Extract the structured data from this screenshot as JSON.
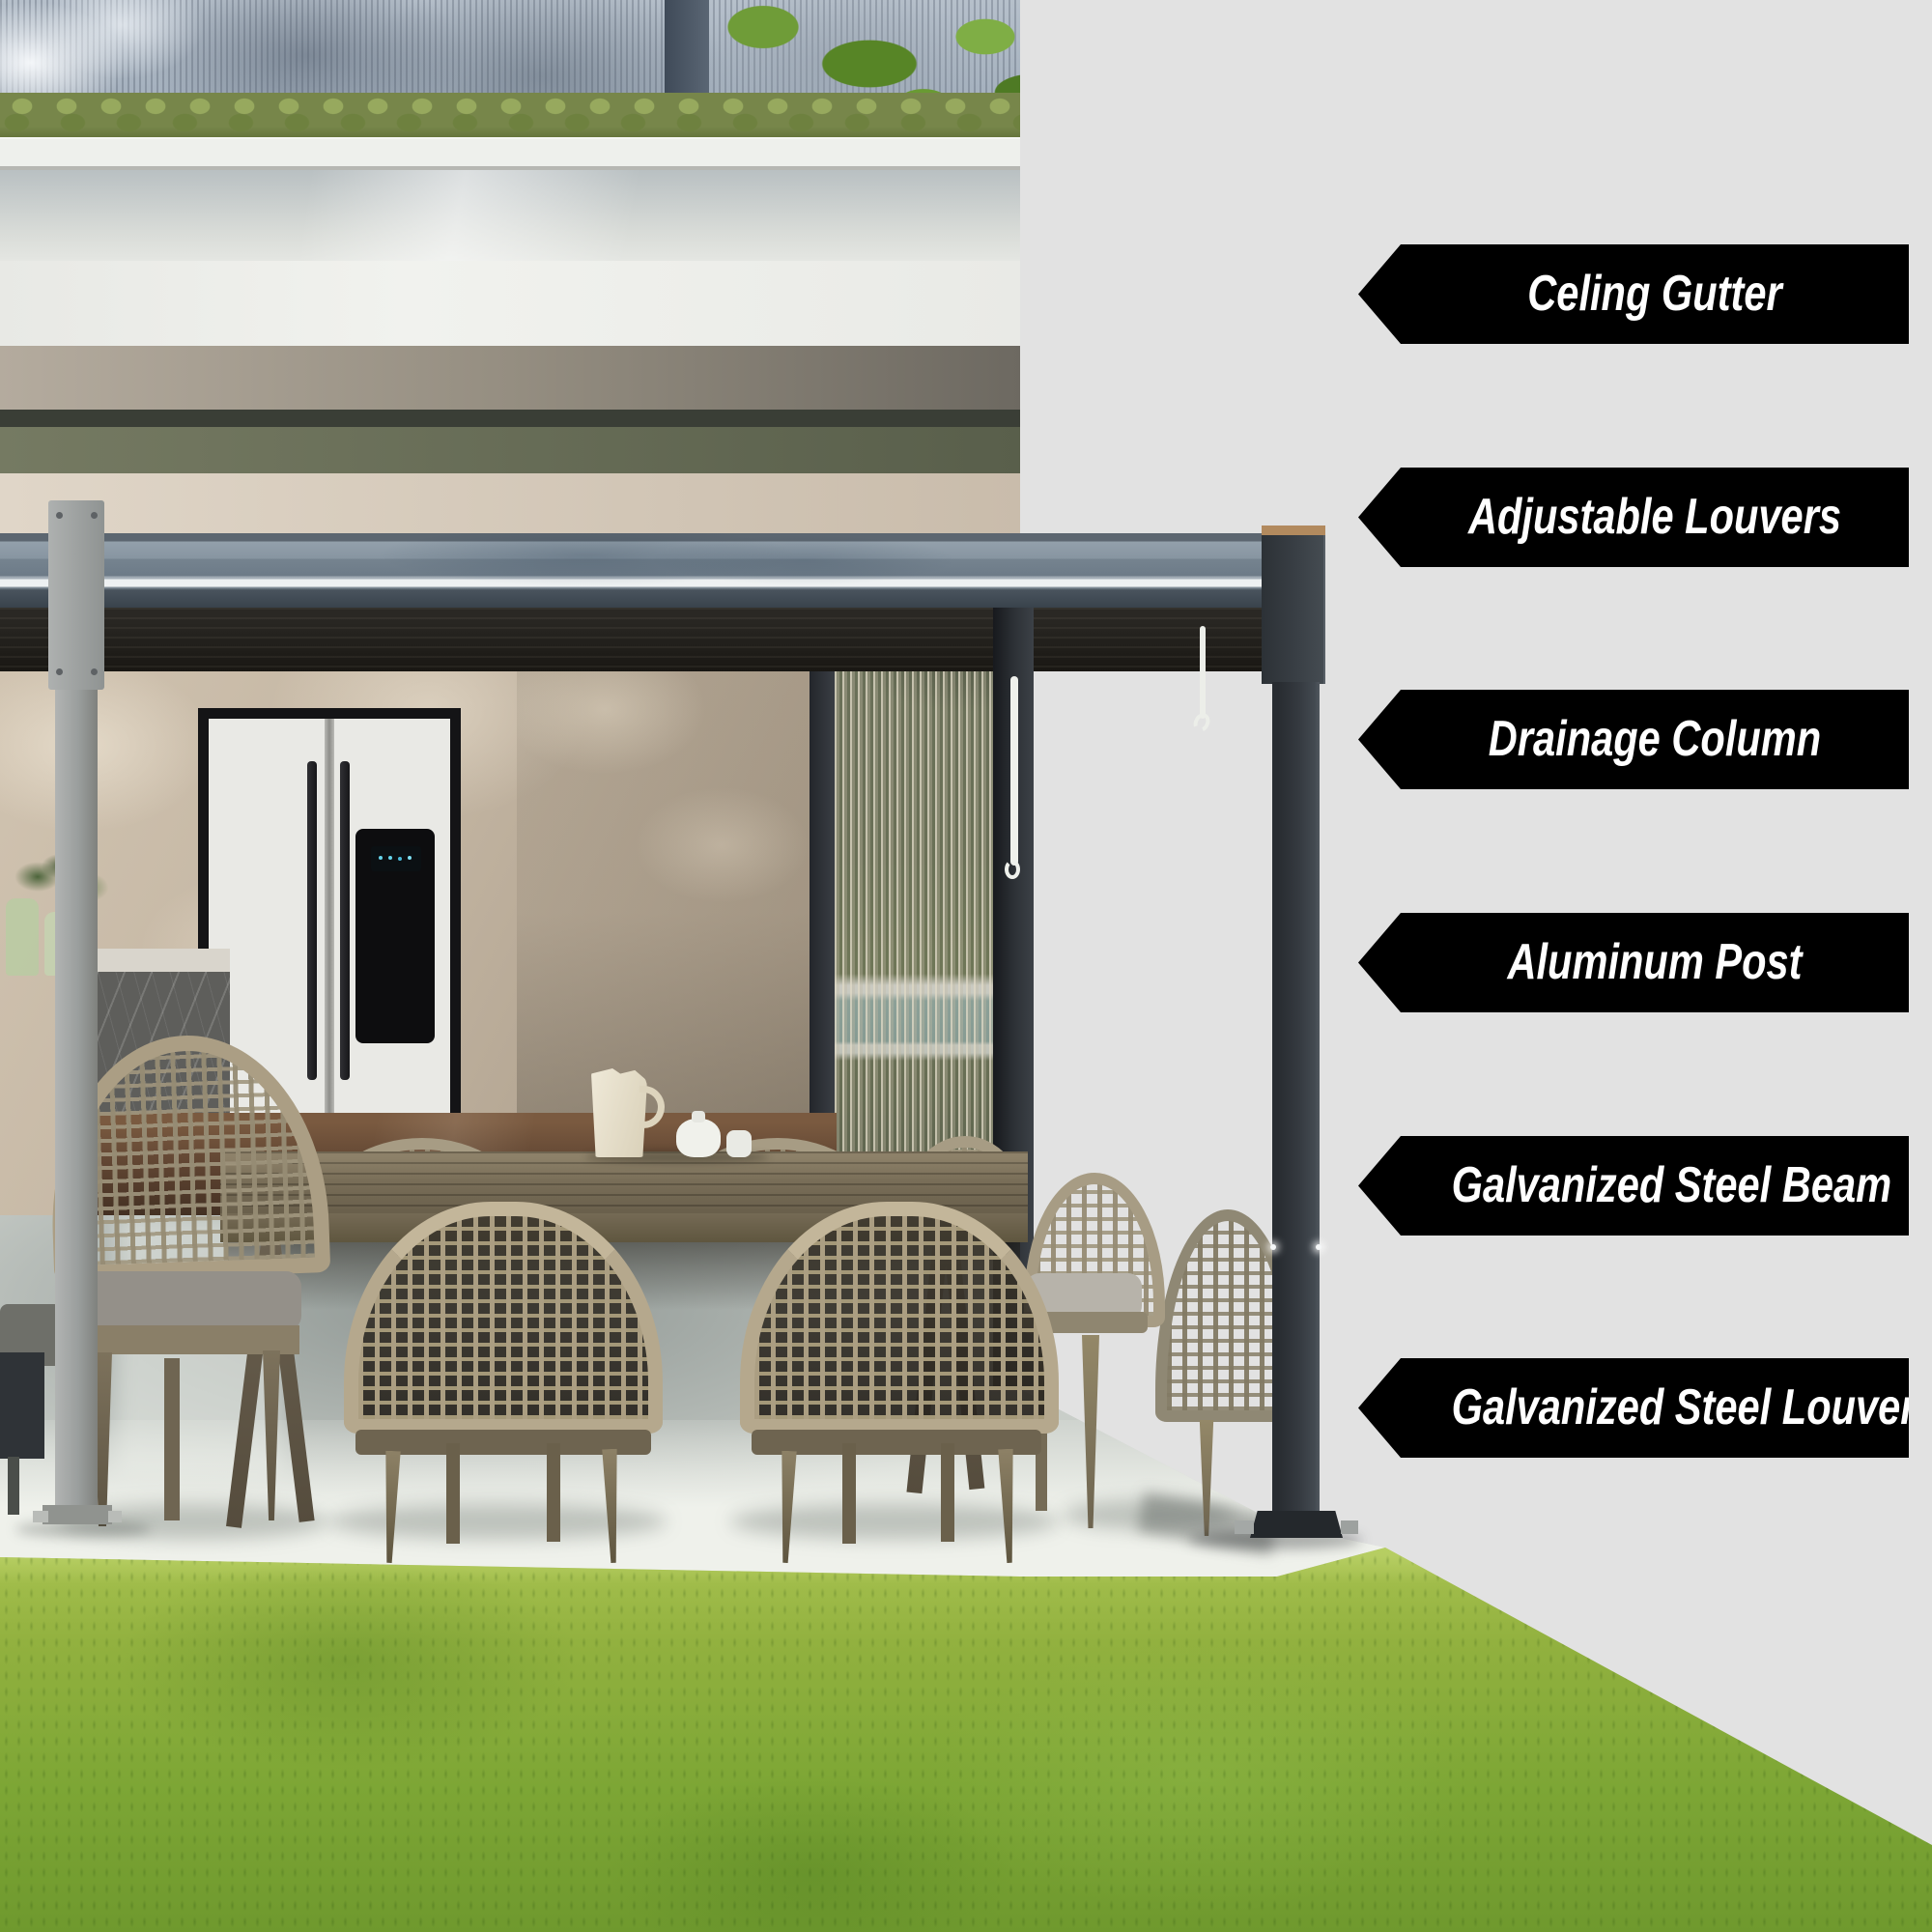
{
  "image_type": "pergola product feature infographic",
  "panel": {
    "background": "#e2e2e2"
  },
  "callouts": {
    "shape": "left-pointing-arrow",
    "colors": {
      "background": "#000000",
      "text": "#ffffff"
    },
    "items": [
      {
        "label": "Celing Gutter"
      },
      {
        "label": "Adjustable Louvers"
      },
      {
        "label": "Drainage Column"
      },
      {
        "label": "Aluminum Post"
      },
      {
        "label": "Galvanized Steel Beam"
      },
      {
        "label": "Galvanized Steel Louvers"
      }
    ]
  },
  "photo": {
    "description": "Modern house terrace with louvered aluminum pergola over an outdoor dining set with wicker chairs, concrete patio and green lawn",
    "colors": {
      "grass": "#7da635",
      "concrete_sunlit": "#eff1eb",
      "concrete_shaded": "#c9cec9",
      "pergola_frame_dark": "#353a40",
      "pergola_post_light": "#9a9e9d",
      "gutter_metal": "#8795a1",
      "louver_underside": "#211f1b",
      "wicker_chair": "#b5a88d",
      "table_wood": "#6a604c"
    }
  }
}
